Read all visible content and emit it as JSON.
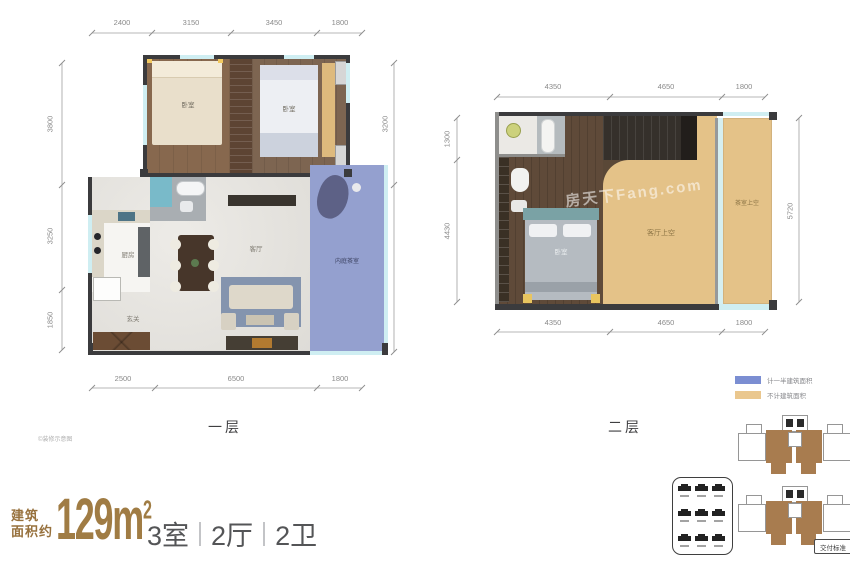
{
  "floor1": {
    "label": "一层",
    "watermark": "©装修示意图",
    "dims_top": [
      "2400",
      "3150",
      "3450",
      "1800"
    ],
    "dims_bottom": [
      "2500",
      "6500",
      "1800"
    ],
    "dims_left": [
      "3800",
      "3250",
      "1850"
    ],
    "dims_right": [
      "3200",
      "5700"
    ],
    "rooms": {
      "bedroom_left": "卧室",
      "bedroom_right": "卧室",
      "kitchen": "厨房",
      "living": "客厅",
      "entry": "玄关",
      "tea_room": "内庭茶室"
    }
  },
  "floor2": {
    "label": "二层",
    "watermark": "房天下Fang.com",
    "dims_top": [
      "4350",
      "4650",
      "1800"
    ],
    "dims_bottom": [
      "4350",
      "4650",
      "1800"
    ],
    "dims_left": [
      "1300",
      "4430"
    ],
    "dims_right": [
      "5720"
    ],
    "rooms": {
      "bedroom": "卧室",
      "living_void": "客厅上空",
      "terrace_void": "茶室上空"
    }
  },
  "legend": {
    "items": [
      {
        "label": "计一半建筑面积",
        "color": "#7b8ed2"
      },
      {
        "label": "不计建筑面积",
        "color": "#eac78e"
      }
    ]
  },
  "summary": {
    "area_prefix_line1": "建筑",
    "area_prefix_line2": "面积约",
    "area_value": "129m",
    "area_superscript": "2",
    "units": [
      "3室",
      "2厅",
      "2卫"
    ]
  },
  "keyplate": {
    "tag": "交付标准"
  },
  "colors": {
    "accent_brown": "#a07c44",
    "wall_dark": "#3b3b3d",
    "half_area_blue": "#7b8ed2",
    "no_area_tan": "#e4c288",
    "window_teal": "#cfeef2"
  }
}
